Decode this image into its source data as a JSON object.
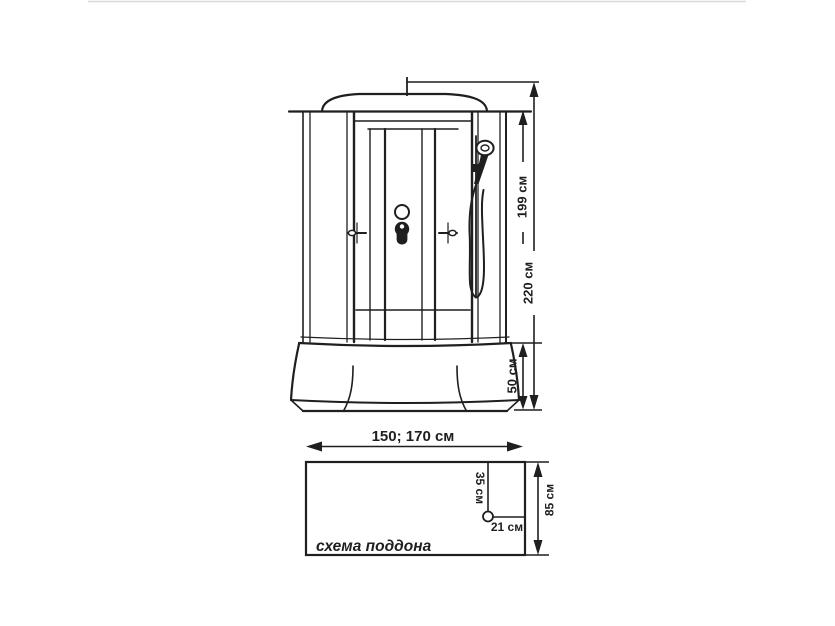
{
  "diagram": {
    "type": "technical-drawing",
    "subject": "shower-cabin-dimensions",
    "colors": {
      "line": "#1f1f1f",
      "background": "#ffffff",
      "frame_edge": "#d9d9d9"
    },
    "front_view": {
      "dim_roof_height": "199 см",
      "dim_total_height": "220 см",
      "dim_tray_height": "50 см",
      "dim_width": "150; 170 см"
    },
    "tray_plan": {
      "caption": "схема поддона",
      "dim_depth": "85 см",
      "dim_drain_from_top": "35 см",
      "dim_drain_from_right": "21 см"
    }
  }
}
